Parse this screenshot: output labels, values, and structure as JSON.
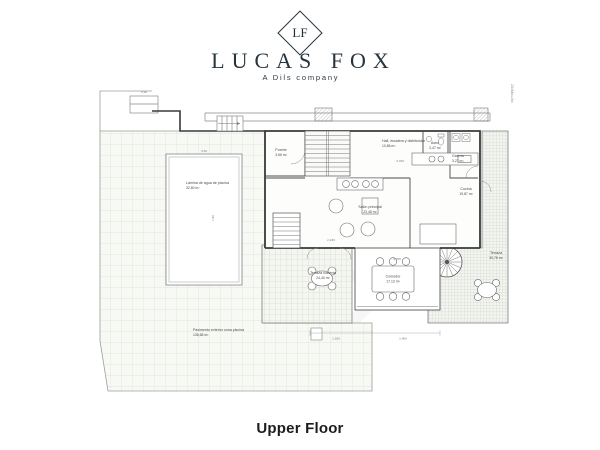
{
  "brand": {
    "monogram": "LF",
    "name": "LUCAS FOX",
    "tagline": "A Dils company"
  },
  "plan": {
    "side_ref": "234Mpu-lbc",
    "rooms": [
      {
        "id": "porche",
        "label": "Porche",
        "area": "3,66 m²"
      },
      {
        "id": "hall",
        "label": "Hall, escalera y distribuidor",
        "area": "10,86 m²"
      },
      {
        "id": "aseo",
        "label": "Aseo",
        "area": "2,47 m²"
      },
      {
        "id": "galeria",
        "label": "Galería",
        "area": "3,27 m²"
      },
      {
        "id": "cocina",
        "label": "Cocina",
        "area": "19,87 m²"
      },
      {
        "id": "salon",
        "label": "Salón principal",
        "area": "23,48 m²"
      },
      {
        "id": "comedor",
        "label": "Comedor",
        "area": "17,13 m²"
      },
      {
        "id": "terraza-cubierta",
        "label": "Terraza cubierta",
        "area": "24,40 m²"
      },
      {
        "id": "terraza",
        "label": "Terraza",
        "area": "30,78 m²"
      },
      {
        "id": "piscina",
        "label": "Lámina de agua de piscina",
        "area": "32,80 m²"
      },
      {
        "id": "pavimento",
        "label": "Pavimento exterior zona piscina",
        "area": "136,68 m²"
      }
    ],
    "dims": [
      "0,90",
      "3,52",
      "7,52",
      "4,790",
      "2,230",
      "4,795",
      "1,185",
      "1,400"
    ]
  },
  "footer": {
    "title": "Upper Floor"
  },
  "colors": {
    "brand": "#233038",
    "wall": "#3a3a3a",
    "deck_grid": "#dbe0d4",
    "terrace_grid": "#c3cabd"
  }
}
